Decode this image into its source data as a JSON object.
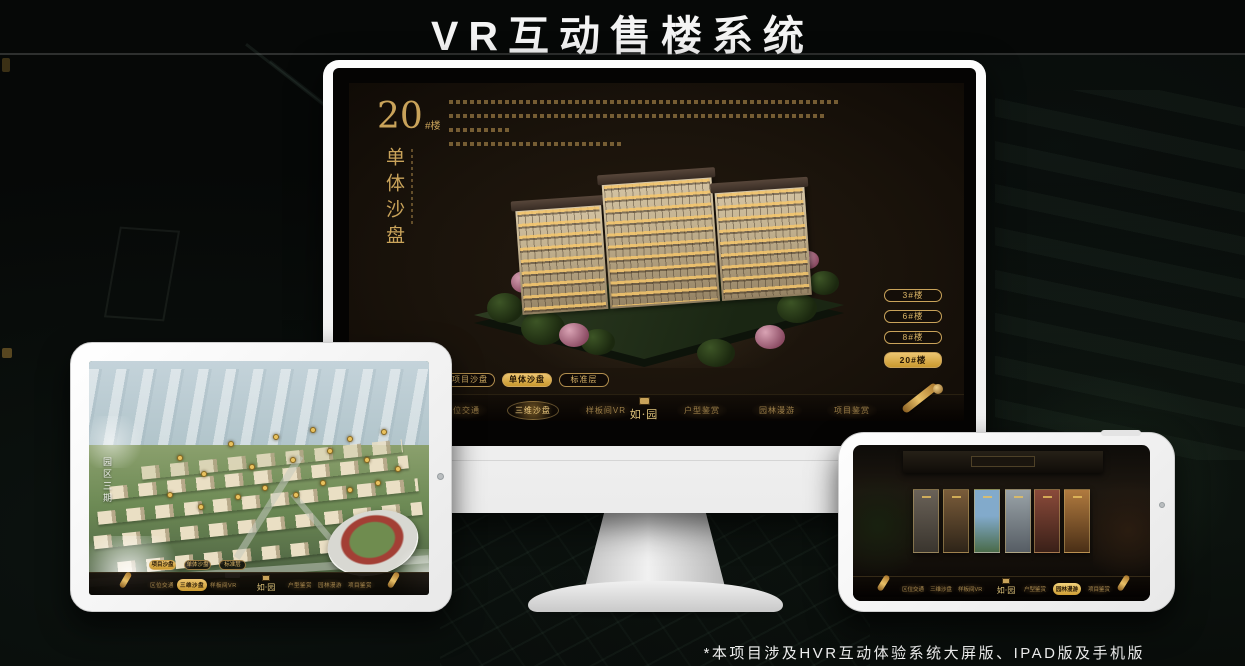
{
  "page": {
    "title": "VR互动售楼系统",
    "footnote": "*本项目涉及HVR互动体验系统大屏版、IPAD版及手机版"
  },
  "brand": {
    "logo_text": "如·园"
  },
  "colors": {
    "gold": "#C9A35A",
    "gold_bright": "#ECC571",
    "screen_bg": "#1A130B"
  },
  "monitor": {
    "heading": {
      "number": "20",
      "suffix": "#楼",
      "subtitle_vertical": "单体沙盘"
    },
    "floor_buttons": [
      {
        "label": "3#楼"
      },
      {
        "label": "6#楼"
      },
      {
        "label": "8#楼"
      },
      {
        "label": "20#楼",
        "active": true
      }
    ],
    "sub_tabs": [
      {
        "label": "项目沙盘"
      },
      {
        "label": "单体沙盘",
        "active": true
      },
      {
        "label": "标准层"
      }
    ],
    "menu_left": [
      {
        "label": "区位交通"
      },
      {
        "label": "三维沙盘",
        "active": true
      },
      {
        "label": "样板间VR"
      }
    ],
    "menu_right": [
      {
        "label": "户型鉴赏"
      },
      {
        "label": "园林漫游"
      },
      {
        "label": "项目鉴赏"
      }
    ]
  },
  "tablet": {
    "area_label_vertical": "园区三期",
    "sub_tabs": [
      {
        "label": "项目沙盘",
        "active": true
      },
      {
        "label": "单体沙盘"
      },
      {
        "label": "标准层"
      }
    ],
    "menu_left": [
      {
        "label": "区位交通"
      },
      {
        "label": "三维沙盘",
        "active": true
      },
      {
        "label": "样板间VR"
      }
    ],
    "menu_right": [
      {
        "label": "户型鉴赏"
      },
      {
        "label": "园林漫游"
      },
      {
        "label": "项目鉴赏"
      }
    ],
    "markers": [
      [
        26,
        40
      ],
      [
        33,
        47
      ],
      [
        41,
        34
      ],
      [
        47,
        44
      ],
      [
        54,
        31
      ],
      [
        59,
        41
      ],
      [
        65,
        28
      ],
      [
        70,
        37
      ],
      [
        76,
        32
      ],
      [
        81,
        41
      ],
      [
        86,
        29
      ],
      [
        23,
        56
      ],
      [
        32,
        61
      ],
      [
        43,
        57
      ],
      [
        51,
        53
      ],
      [
        60,
        56
      ],
      [
        68,
        51
      ],
      [
        76,
        54
      ],
      [
        84,
        51
      ],
      [
        90,
        45
      ]
    ]
  },
  "phone": {
    "menu_left": [
      {
        "label": "区位交通"
      },
      {
        "label": "三维沙盘"
      },
      {
        "label": "样板间VR"
      }
    ],
    "menu_right": [
      {
        "label": "户型鉴赏"
      },
      {
        "label": "园林漫游",
        "active": true
      },
      {
        "label": "项目鉴赏"
      }
    ]
  }
}
